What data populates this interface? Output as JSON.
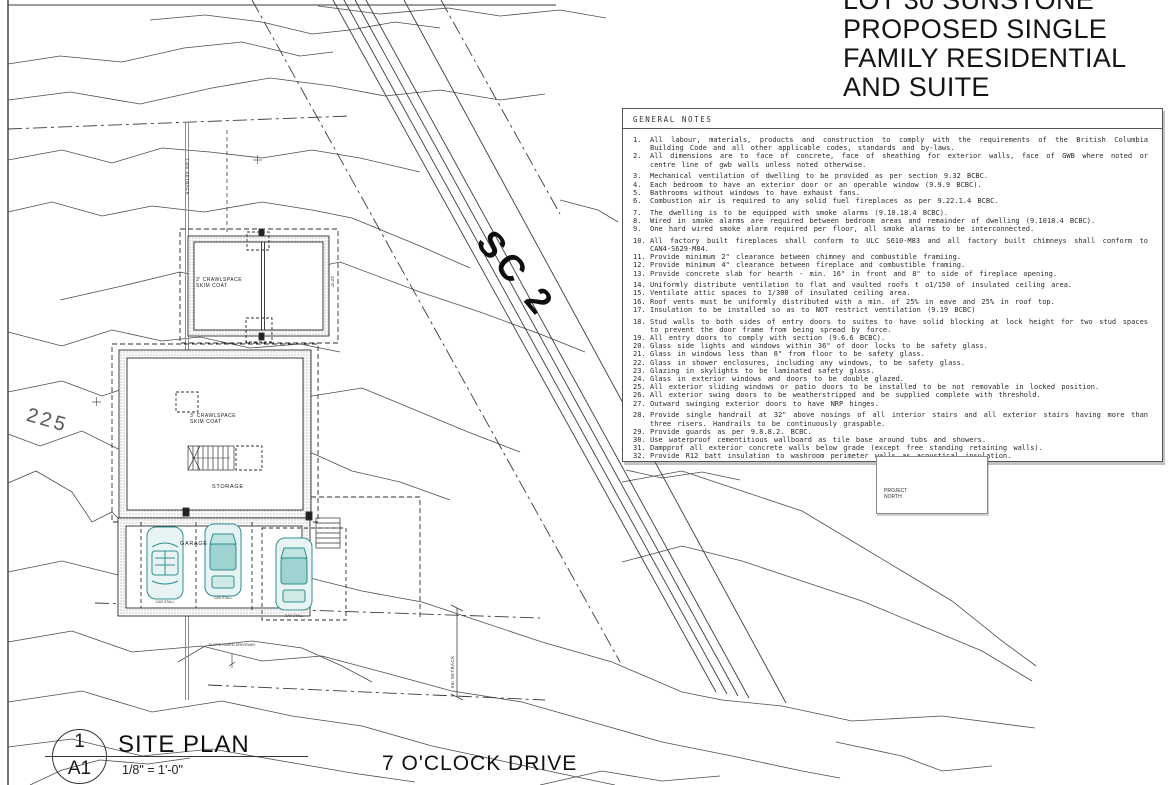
{
  "sheet": {
    "project_title_lines": [
      "LOT 30 SUNSTONE",
      "PROPOSED SINGLE",
      "FAMILY RESIDENTIAL",
      "AND SUITE"
    ],
    "street_name": "7 O'CLOCK DRIVE",
    "sheet_ref": {
      "detail": "1",
      "sheet": "A1",
      "title": "SITE PLAN",
      "scale": "1/8\" = 1'-0\""
    },
    "north": {
      "line1": "PROJECT",
      "line2": "NORTH"
    },
    "road_label": "SC 2",
    "contour_label": "225"
  },
  "plan_labels": {
    "setback_75": "7.5m SETBACK",
    "setback_6": "6m SETBACK",
    "crawlspace_upper": "3' CRAWLSPACE SKIM COAT",
    "crawlspace_lower": "3' CRAWLSPACE SKIM COAT",
    "storage": "STORAGE",
    "garage": "GARAGE",
    "dim_22": "22'-0\"",
    "driveway_note": "SLOPE PAVED DRIVEWAY",
    "stall_label": "CAR STALL"
  },
  "general_notes": {
    "header": "GENERAL NOTES",
    "items": [
      {
        "n": "1.",
        "gap": false,
        "t": "All labour, materials, products and construction to comply with the requirements of the British Columbia Building Code and all other applicable codes, standards and by-laws."
      },
      {
        "n": "2.",
        "gap": false,
        "t": "All dimensions are to face of concrete, face of sheathing for exterior walls, face of GWB where noted or centre line of gwb walls unless noted otherwise."
      },
      {
        "n": "3.",
        "gap": true,
        "t": "Mechanical ventilation of dwelling to be provided as per section 9.32 BCBC."
      },
      {
        "n": "4.",
        "gap": false,
        "t": "Each bedroom to have an exterior door or an operable window (9.9.9 BCBC)."
      },
      {
        "n": "5.",
        "gap": false,
        "t": "Bathrooms without windows to have exhaust fans."
      },
      {
        "n": "6.",
        "gap": false,
        "t": "Combustion air is required to any solid fuel fireplaces as per 9.22.1.4 BCBC."
      },
      {
        "n": "7.",
        "gap": true,
        "t": "The dwelling is to be equipped with smoke alarms (9.10.18.4 BCBC)."
      },
      {
        "n": "8.",
        "gap": false,
        "t": "Wired in smoke alarms are required between bedroom areas and remainder of dwelling (9.1018.4 BCBC)."
      },
      {
        "n": "9.",
        "gap": false,
        "t": "One hard wired smoke alarm required per floor, all smoke alarms to be interconnected."
      },
      {
        "n": "10.",
        "gap": true,
        "t": "All factory built fireplaces shall conform to ULC S610-M83 and all factory built chimneys shall conform to CAN4-S629-M84."
      },
      {
        "n": "11.",
        "gap": false,
        "t": "Provide minimum 2\" clearance between chimney and combustible framiing."
      },
      {
        "n": "12.",
        "gap": false,
        "t": "Provide minimum 4\" clearance between fireplace and combustible framing."
      },
      {
        "n": "13.",
        "gap": false,
        "t": "Provide concrete slab for hearth - min. 16\" in front and 8\" to side of fireplace opening."
      },
      {
        "n": "14.",
        "gap": true,
        "t": "Uniformly distribute ventilation to flat and vaulted roofs t o1/150 of insulated ceiling area."
      },
      {
        "n": "15.",
        "gap": false,
        "t": "Ventilate attic spaces to 1/300 of insulated ceiling area."
      },
      {
        "n": "16.",
        "gap": false,
        "t": "Roof vents must be uniformly distributed with a min. of 25% in eave and 25% in roof top."
      },
      {
        "n": "17.",
        "gap": false,
        "t": "Insulation to be installed so as to NOT restrict ventilation (9.19 BCBC)"
      },
      {
        "n": "18.",
        "gap": true,
        "t": "Stud walls to both sides of entry doors to suites to have solid blocking at lock height for two stud spaces to prevent the door frame from being spread by force."
      },
      {
        "n": "19.",
        "gap": false,
        "t": "All entry doors to comply with section (9.6.6 BCBC)."
      },
      {
        "n": "20.",
        "gap": false,
        "t": "Glass side lights and windows within 36\" of door locks to be safety glass."
      },
      {
        "n": "21.",
        "gap": false,
        "t": "Glass in windows less than 8\" from floor to be safety glass."
      },
      {
        "n": "22.",
        "gap": false,
        "t": "Glass in shower enclosures, including any windows, to be safety glass."
      },
      {
        "n": "23.",
        "gap": false,
        "t": "Glazing in skylights to be laminated safety glass."
      },
      {
        "n": "24.",
        "gap": false,
        "t": "Glass in exterior windows and doors to be double glazed."
      },
      {
        "n": "25.",
        "gap": false,
        "t": "All exterior sliding windows or patio doors to be installed to be not removable in locked position."
      },
      {
        "n": "26.",
        "gap": false,
        "t": "All exterior swing doors to be weatherstripped and be supplied complete with threshold."
      },
      {
        "n": "27.",
        "gap": false,
        "t": "Outward swinging exterior doors to have NRP hinges."
      },
      {
        "n": "28.",
        "gap": true,
        "t": "Provide single handrail at 32\" above nosings of all interior stairs and all exterior stairs having more than three risers. Handrails to be continuously graspable."
      },
      {
        "n": "29.",
        "gap": false,
        "t": "Provide guards as per 9.8.8.2. BCBC."
      },
      {
        "n": "30.",
        "gap": false,
        "t": "Use waterproof cementitious wallboard as tile base around tubs and showers."
      },
      {
        "n": "31.",
        "gap": false,
        "t": "Dampprof all exterior concrete walls below grade (except free standing retaining walls)."
      },
      {
        "n": "32.",
        "gap": false,
        "t": "Provide R12 batt insulation to washroom perimeter walls as acoustical insulation."
      }
    ]
  }
}
